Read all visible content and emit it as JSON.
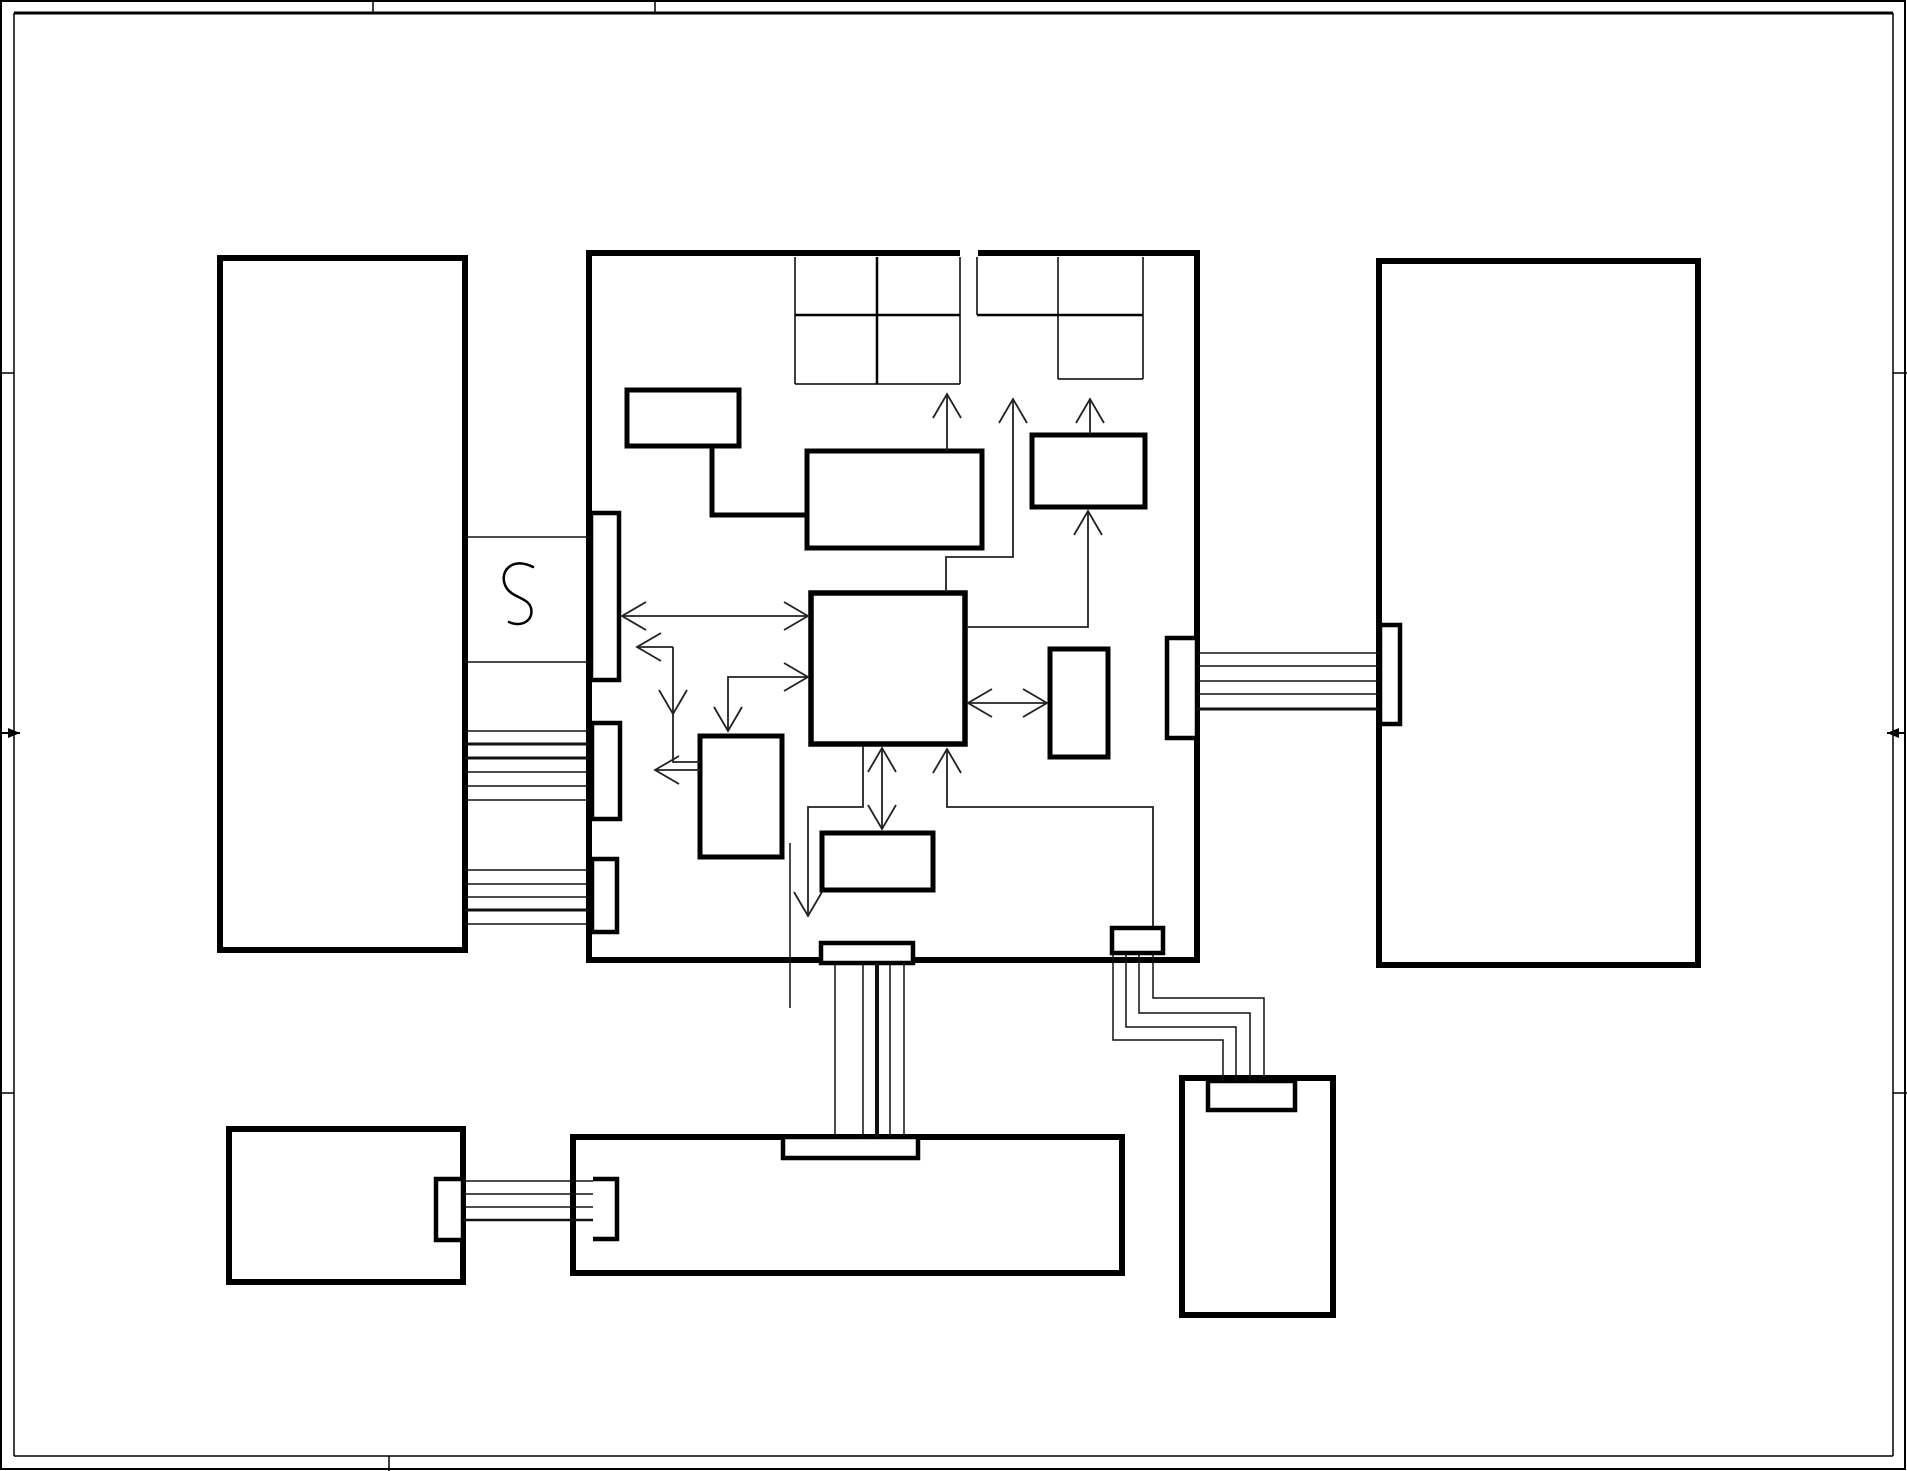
{
  "title": "block-diagram-schematic-sheet",
  "canvas": {
    "w": 1907,
    "h": 1471,
    "bg": "#ffffff",
    "ink": "#000000",
    "wire": "#222222"
  },
  "frame": {
    "outer": {
      "name": "sheet-outer-border",
      "x": 1,
      "y": 1,
      "w": 1904,
      "h": 1468,
      "sw": 2
    },
    "lines": [
      {
        "name": "sheet-inner-border-top",
        "x1": 14,
        "y1": 13,
        "x2": 1893,
        "y2": 13,
        "sw": 3
      },
      {
        "name": "sheet-inner-border-left",
        "x1": 14,
        "y1": 13,
        "x2": 14,
        "y2": 1456,
        "sw": 1.5
      },
      {
        "name": "sheet-inner-border-right",
        "x1": 1893,
        "y1": 13,
        "x2": 1893,
        "y2": 1456,
        "sw": 1.5
      },
      {
        "name": "sheet-inner-border-bottom",
        "x1": 14,
        "y1": 1456,
        "x2": 1893,
        "y2": 1456,
        "sw": 1.5
      }
    ],
    "ticks": [
      {
        "name": "border-tick-top-1",
        "x1": 373,
        "y1": 0,
        "x2": 373,
        "y2": 13,
        "sw": 1.5
      },
      {
        "name": "border-tick-top-2",
        "x1": 655,
        "y1": 0,
        "x2": 655,
        "y2": 13,
        "sw": 1.5
      },
      {
        "name": "border-tick-bottom-1",
        "x1": 389,
        "y1": 1456,
        "x2": 389,
        "y2": 1471,
        "sw": 1.5
      },
      {
        "name": "border-tick-left-1",
        "x1": 0,
        "y1": 373,
        "x2": 14,
        "y2": 373,
        "sw": 1.5
      },
      {
        "name": "border-tick-left-2",
        "x1": 0,
        "y1": 1093,
        "x2": 14,
        "y2": 1093,
        "sw": 1.5
      },
      {
        "name": "border-tick-right-1",
        "x1": 1893,
        "y1": 373,
        "x2": 1907,
        "y2": 373,
        "sw": 1.5
      },
      {
        "name": "border-tick-right-2",
        "x1": 1893,
        "y1": 1093,
        "x2": 1907,
        "y2": 1093,
        "sw": 1.5
      }
    ],
    "edge_arrows": [
      {
        "name": "left-centering-arrow",
        "x1": 2,
        "y1": 733,
        "x2": 20,
        "y2": 733,
        "dir": "right"
      },
      {
        "name": "right-centering-arrow",
        "x1": 1905,
        "y1": 733,
        "x2": 1887,
        "y2": 733,
        "dir": "left"
      }
    ]
  },
  "blocks": [
    {
      "name": "left-tall-block",
      "x": 220,
      "y": 258,
      "w": 245,
      "h": 692,
      "sw": 6
    },
    {
      "name": "central-main-block",
      "x": 589,
      "y": 253,
      "w": 608,
      "h": 707,
      "sw": 6
    },
    {
      "name": "right-tall-block",
      "x": 1379,
      "y": 261,
      "w": 319,
      "h": 704,
      "sw": 6
    },
    {
      "name": "bottom-left-block",
      "x": 229,
      "y": 1129,
      "w": 234,
      "h": 153,
      "sw": 6
    },
    {
      "name": "bottom-wide-block",
      "x": 573,
      "y": 1137,
      "w": 549,
      "h": 136,
      "sw": 6
    },
    {
      "name": "bottom-right-block",
      "x": 1182,
      "y": 1078,
      "w": 151,
      "h": 237,
      "sw": 6
    }
  ],
  "patches": [
    {
      "name": "central-top-border-gap",
      "x": 960,
      "y": 248,
      "w": 18,
      "h": 10
    }
  ],
  "grids": [
    {
      "name": "grid-left-v1",
      "x1": 795,
      "y1": 257,
      "x2": 795,
      "y2": 384,
      "sw": 1.5
    },
    {
      "name": "grid-left-v2",
      "x1": 877,
      "y1": 257,
      "x2": 877,
      "y2": 384,
      "sw": 2.5
    },
    {
      "name": "grid-left-v3",
      "x1": 960,
      "y1": 257,
      "x2": 960,
      "y2": 384,
      "sw": 1.5
    },
    {
      "name": "grid-left-hmid",
      "x1": 795,
      "y1": 315,
      "x2": 960,
      "y2": 315,
      "sw": 2.5
    },
    {
      "name": "grid-left-hbot",
      "x1": 795,
      "y1": 384,
      "x2": 960,
      "y2": 384,
      "sw": 1.5
    },
    {
      "name": "grid-right-v1",
      "x1": 977,
      "y1": 257,
      "x2": 977,
      "y2": 315,
      "sw": 1.5
    },
    {
      "name": "grid-right-v2",
      "x1": 1058,
      "y1": 257,
      "x2": 1058,
      "y2": 379,
      "sw": 1.5
    },
    {
      "name": "grid-right-v3",
      "x1": 1143,
      "y1": 257,
      "x2": 1143,
      "y2": 379,
      "sw": 1.5
    },
    {
      "name": "grid-right-hmid",
      "x1": 977,
      "y1": 315,
      "x2": 1143,
      "y2": 315,
      "sw": 2.5
    },
    {
      "name": "grid-right-hbot",
      "x1": 1058,
      "y1": 379,
      "x2": 1143,
      "y2": 379,
      "sw": 1.5
    }
  ],
  "inner_rects": [
    {
      "name": "osc-small-rect",
      "x": 627,
      "y": 390,
      "w": 112,
      "h": 56,
      "sw": 5
    },
    {
      "name": "control-mid-rect",
      "x": 807,
      "y": 451,
      "w": 175,
      "h": 97,
      "sw": 5
    },
    {
      "name": "top-right-small-rect",
      "x": 1032,
      "y": 435,
      "w": 113,
      "h": 72,
      "sw": 5
    },
    {
      "name": "cpu-core-rect",
      "x": 811,
      "y": 593,
      "w": 154,
      "h": 151,
      "sw": 5.5
    },
    {
      "name": "right-small-rect",
      "x": 1050,
      "y": 649,
      "w": 58,
      "h": 108,
      "sw": 5
    },
    {
      "name": "below-left-rect",
      "x": 700,
      "y": 736,
      "w": 82,
      "h": 121,
      "sw": 5
    },
    {
      "name": "below-center-rect",
      "x": 822,
      "y": 833,
      "w": 111,
      "h": 57,
      "sw": 5
    }
  ],
  "pads": [
    {
      "name": "left-edge-pad-1",
      "x": 591,
      "y": 513,
      "w": 28,
      "h": 167,
      "sw": 4.5
    },
    {
      "name": "left-edge-pad-2",
      "x": 592,
      "y": 723,
      "w": 28,
      "h": 96,
      "sw": 4.5
    },
    {
      "name": "left-edge-pad-3",
      "x": 592,
      "y": 859,
      "w": 25,
      "h": 73,
      "sw": 4.5
    },
    {
      "name": "right-edge-pad",
      "x": 1167,
      "y": 638,
      "w": 30,
      "h": 100,
      "sw": 4.5
    },
    {
      "name": "bottom-edge-pad",
      "x": 821,
      "y": 943,
      "w": 92,
      "h": 20,
      "sw": 4.5
    },
    {
      "name": "bottom-right-small-pad",
      "x": 1112,
      "y": 928,
      "w": 51,
      "h": 25,
      "sw": 4.5
    },
    {
      "name": "right-block-left-pad",
      "x": 1380,
      "y": 625,
      "w": 20,
      "h": 99,
      "sw": 4.5
    },
    {
      "name": "bottom-left-block-pad",
      "x": 436,
      "y": 1179,
      "w": 27,
      "h": 61,
      "sw": 4.5
    },
    {
      "name": "bottom-wide-top-pad",
      "x": 783,
      "y": 1137,
      "w": 135,
      "h": 21,
      "sw": 4.5
    },
    {
      "name": "bottom-right-top-pad",
      "x": 1208,
      "y": 1081,
      "w": 87,
      "h": 29,
      "sw": 4.5
    }
  ],
  "open_pads": [
    {
      "name": "bottom-wide-left-open-pad",
      "x": 593,
      "y": 1179,
      "w": 24,
      "h": 60,
      "sw": 4.5
    }
  ],
  "thick_connectors": [
    {
      "name": "osc-elbow-connector",
      "points": [
        [
          712,
          446
        ],
        [
          712,
          515
        ],
        [
          807,
          515
        ]
      ],
      "sw": 5
    }
  ],
  "squiggle": {
    "name": "squiggle-symbol",
    "path": "M 533 567 C 512 556, 498 572, 506 587 C 512 598, 528 597, 531 608 C 534 620, 522 628, 509 622",
    "sw": 2.5
  },
  "wires": [
    {
      "name": "crystal-box-top",
      "x1": 465,
      "y1": 537,
      "x2": 589,
      "y2": 537,
      "sw": 1.5
    },
    {
      "name": "crystal-box-bottom",
      "x1": 465,
      "y1": 662,
      "x2": 589,
      "y2": 662,
      "sw": 1.5
    },
    {
      "name": "left-bus-a-1",
      "x1": 465,
      "y1": 731,
      "x2": 589,
      "y2": 731,
      "sw": 1.5
    },
    {
      "name": "left-bus-a-2",
      "x1": 465,
      "y1": 744,
      "x2": 589,
      "y2": 744,
      "sw": 3
    },
    {
      "name": "left-bus-a-3",
      "x1": 465,
      "y1": 758,
      "x2": 589,
      "y2": 758,
      "sw": 3
    },
    {
      "name": "left-bus-a-4",
      "x1": 465,
      "y1": 772,
      "x2": 589,
      "y2": 772,
      "sw": 1.5
    },
    {
      "name": "left-bus-a-5",
      "x1": 465,
      "y1": 786,
      "x2": 589,
      "y2": 786,
      "sw": 1.5
    },
    {
      "name": "left-bus-a-6",
      "x1": 465,
      "y1": 800,
      "x2": 589,
      "y2": 800,
      "sw": 1.5
    },
    {
      "name": "left-bus-b-1",
      "x1": 465,
      "y1": 870,
      "x2": 589,
      "y2": 870,
      "sw": 1.5
    },
    {
      "name": "left-bus-b-2",
      "x1": 465,
      "y1": 884,
      "x2": 589,
      "y2": 884,
      "sw": 1.5
    },
    {
      "name": "left-bus-b-3",
      "x1": 465,
      "y1": 897,
      "x2": 589,
      "y2": 897,
      "sw": 1.5
    },
    {
      "name": "left-bus-b-4",
      "x1": 465,
      "y1": 910,
      "x2": 589,
      "y2": 910,
      "sw": 3
    },
    {
      "name": "left-bus-b-5",
      "x1": 465,
      "y1": 924,
      "x2": 589,
      "y2": 924,
      "sw": 1.5
    },
    {
      "name": "right-bus-1",
      "x1": 1197,
      "y1": 653,
      "x2": 1379,
      "y2": 653,
      "sw": 1.5
    },
    {
      "name": "right-bus-2",
      "x1": 1197,
      "y1": 666,
      "x2": 1379,
      "y2": 666,
      "sw": 1.5
    },
    {
      "name": "right-bus-3",
      "x1": 1197,
      "y1": 681,
      "x2": 1379,
      "y2": 681,
      "sw": 1.5
    },
    {
      "name": "right-bus-4",
      "x1": 1197,
      "y1": 694,
      "x2": 1379,
      "y2": 694,
      "sw": 1.5
    },
    {
      "name": "right-bus-5",
      "x1": 1197,
      "y1": 709,
      "x2": 1379,
      "y2": 709,
      "sw": 3
    },
    {
      "name": "bottom-bus-1",
      "x1": 463,
      "y1": 1181,
      "x2": 593,
      "y2": 1181,
      "sw": 1.5
    },
    {
      "name": "bottom-bus-2",
      "x1": 463,
      "y1": 1194,
      "x2": 593,
      "y2": 1194,
      "sw": 1.5
    },
    {
      "name": "bottom-bus-3",
      "x1": 463,
      "y1": 1207,
      "x2": 593,
      "y2": 1207,
      "sw": 1.5
    },
    {
      "name": "bottom-bus-4",
      "x1": 463,
      "y1": 1220,
      "x2": 593,
      "y2": 1220,
      "sw": 2.5
    },
    {
      "name": "vertical-bus-1",
      "x1": 835,
      "y1": 963,
      "x2": 835,
      "y2": 1137,
      "sw": 1.5
    },
    {
      "name": "vertical-bus-2",
      "x1": 863,
      "y1": 963,
      "x2": 863,
      "y2": 1137,
      "sw": 1.5
    },
    {
      "name": "vertical-bus-3",
      "x1": 877,
      "y1": 963,
      "x2": 877,
      "y2": 1137,
      "sw": 4
    },
    {
      "name": "vertical-bus-4",
      "x1": 890,
      "y1": 963,
      "x2": 890,
      "y2": 1137,
      "sw": 1.5
    },
    {
      "name": "vertical-bus-5",
      "x1": 904,
      "y1": 963,
      "x2": 904,
      "y2": 1137,
      "sw": 1.5
    },
    {
      "name": "floating-vertical-line",
      "x1": 790,
      "y1": 843,
      "x2": 790,
      "y2": 1008,
      "sw": 1.5
    }
  ],
  "wire_paths": [
    {
      "name": "stepped-line-1",
      "points": [
        [
          1113,
          955
        ],
        [
          1113,
          1040
        ],
        [
          1223,
          1040
        ],
        [
          1223,
          1081
        ]
      ],
      "sw": 1.5
    },
    {
      "name": "stepped-line-2",
      "points": [
        [
          1126,
          955
        ],
        [
          1126,
          1027
        ],
        [
          1236,
          1027
        ],
        [
          1236,
          1081
        ]
      ],
      "sw": 1.5
    },
    {
      "name": "stepped-line-3",
      "points": [
        [
          1139,
          955
        ],
        [
          1139,
          1013
        ],
        [
          1250,
          1013
        ],
        [
          1250,
          1081
        ]
      ],
      "sw": 1.5
    },
    {
      "name": "stepped-line-4",
      "points": [
        [
          1153,
          955
        ],
        [
          1153,
          998
        ],
        [
          1264,
          998
        ],
        [
          1264,
          1081
        ]
      ],
      "sw": 1.5
    }
  ],
  "arrows": [
    {
      "name": "arrow-midrect-to-grid",
      "points": [
        [
          947,
          451
        ],
        [
          947,
          394
        ]
      ],
      "sw": 1.8,
      "heads": [
        {
          "x": 947,
          "y": 394,
          "dir": "up"
        }
      ]
    },
    {
      "name": "arrow-cpu-top-to-grid",
      "points": [
        [
          946,
          592
        ],
        [
          946,
          557
        ],
        [
          1013,
          557
        ],
        [
          1013,
          399
        ]
      ],
      "sw": 1.8,
      "heads": [
        {
          "x": 1013,
          "y": 399,
          "dir": "up"
        }
      ]
    },
    {
      "name": "arrow-cpu-right-to-toprightrect",
      "points": [
        [
          966,
          627
        ],
        [
          1088,
          627
        ],
        [
          1088,
          511
        ]
      ],
      "sw": 1.8,
      "heads": [
        {
          "x": 1088,
          "y": 511,
          "dir": "up"
        }
      ]
    },
    {
      "name": "arrow-toprightrect-to-grid",
      "points": [
        [
          1090,
          434
        ],
        [
          1090,
          399
        ]
      ],
      "sw": 1.8,
      "heads": [
        {
          "x": 1090,
          "y": 399,
          "dir": "up"
        }
      ]
    },
    {
      "name": "arrow-pad1-cpu-bidirectional",
      "points": [
        [
          622,
          616
        ],
        [
          808,
          616
        ]
      ],
      "sw": 1.8,
      "heads": [
        {
          "x": 622,
          "y": 616,
          "dir": "left"
        },
        {
          "x": 808,
          "y": 616,
          "dir": "right"
        }
      ]
    },
    {
      "name": "arrow-elbow-to-pad1",
      "points": [
        [
          673,
          647
        ],
        [
          637,
          647
        ]
      ],
      "sw": 1.8,
      "heads": [
        {
          "x": 637,
          "y": 647,
          "dir": "left"
        }
      ]
    },
    {
      "name": "arrow-elbow-down-belowleft",
      "points": [
        [
          673,
          647
        ],
        [
          673,
          762
        ],
        [
          700,
          762
        ]
      ],
      "sw": 1.8,
      "heads": [
        {
          "x": 673,
          "y": 714,
          "dir": "down"
        }
      ]
    },
    {
      "name": "arrow-belowleft-to-left",
      "points": [
        [
          700,
          770
        ],
        [
          655,
          770
        ]
      ],
      "sw": 1.8,
      "heads": [
        {
          "x": 655,
          "y": 770,
          "dir": "left"
        }
      ]
    },
    {
      "name": "arrow-cpu-and-belowleft-elbow",
      "points": [
        [
          808,
          677
        ],
        [
          728,
          677
        ],
        [
          728,
          731
        ]
      ],
      "sw": 1.8,
      "heads": [
        {
          "x": 808,
          "y": 677,
          "dir": "right"
        },
        {
          "x": 728,
          "y": 731,
          "dir": "down"
        }
      ]
    },
    {
      "name": "arrow-cpu-belowcenter-bidirectional",
      "points": [
        [
          882,
          748
        ],
        [
          882,
          829
        ]
      ],
      "sw": 1.8,
      "heads": [
        {
          "x": 882,
          "y": 748,
          "dir": "up"
        },
        {
          "x": 882,
          "y": 829,
          "dir": "down"
        }
      ]
    },
    {
      "name": "arrow-cpu-to-bottom-pad",
      "points": [
        [
          863,
          746
        ],
        [
          863,
          807
        ],
        [
          808,
          807
        ],
        [
          808,
          916
        ]
      ],
      "sw": 1.8,
      "heads": [
        {
          "x": 808,
          "y": 916,
          "dir": "down"
        }
      ]
    },
    {
      "name": "arrow-brpad-to-cpu",
      "points": [
        [
          1153,
          926
        ],
        [
          1153,
          807
        ],
        [
          947,
          807
        ],
        [
          947,
          749
        ]
      ],
      "sw": 1.8,
      "heads": [
        {
          "x": 947,
          "y": 749,
          "dir": "up"
        }
      ]
    },
    {
      "name": "arrow-cpu-rightrect-bidirectional",
      "points": [
        [
          968,
          703
        ],
        [
          1047,
          703
        ]
      ],
      "sw": 1.8,
      "heads": [
        {
          "x": 968,
          "y": 703,
          "dir": "left"
        },
        {
          "x": 1047,
          "y": 703,
          "dir": "right"
        }
      ]
    }
  ]
}
